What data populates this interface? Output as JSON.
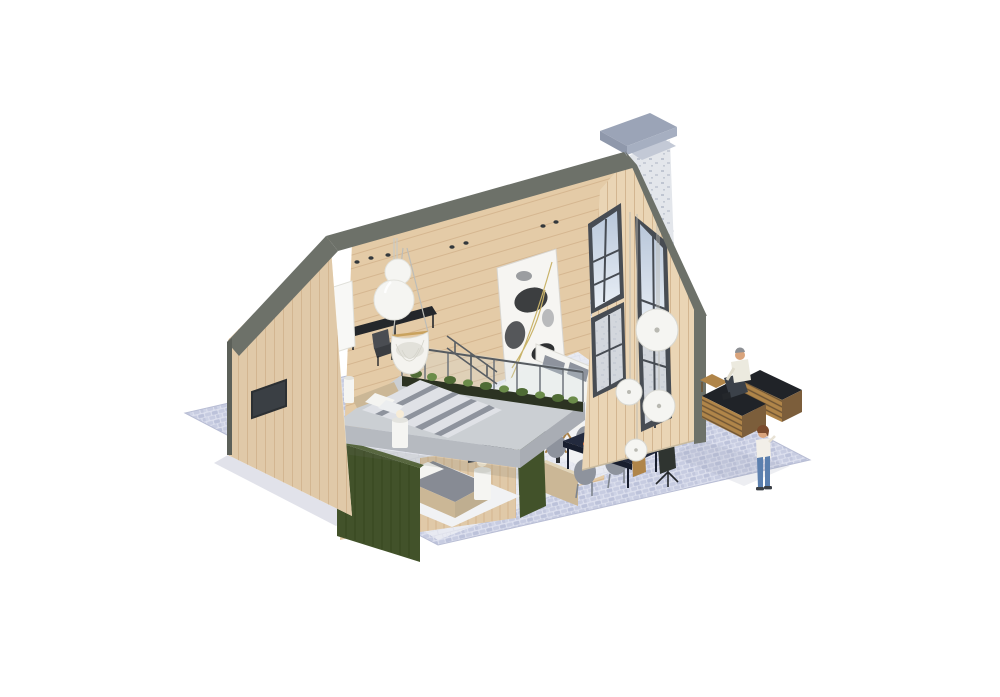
{
  "scene": {
    "type": "isometric-architectural-render",
    "description": "Isometric 3D cutaway render of a barn-style wooden house with loft bedroom, lower bedroom with green wardrobe, living room with white sofa and abstract art, dining area, large gabled window wall with chimney, and an outdoor patio with two people on a cobblestone plaza",
    "objects": [
      "cobblestone-plaza",
      "chimney",
      "roof-trim",
      "rear-gable-wall",
      "wall-window",
      "interior-plank-wall",
      "ceiling-spotlights",
      "sphere-pendant-lamp",
      "hanging-egg-chair",
      "loft-desk",
      "presentation-panel",
      "loft-railing-planter",
      "loft-bed",
      "mezzanine-slab",
      "green-wardrobe",
      "lower-bedroom-bed",
      "nightstand-lamps",
      "green-partition",
      "sideboard",
      "dining-table",
      "dining-chairs",
      "disc-pendant-lamps",
      "floor-lamp",
      "potted-plants",
      "stone-chimney-breast",
      "television",
      "fireplace",
      "abstract-artwork",
      "white-sofa",
      "butterfly-chair",
      "front-gable-window-wall",
      "outdoor-sofa",
      "sitting-man",
      "standing-child"
    ]
  },
  "colors": {
    "background": "#ffffff",
    "roof_trim": "#6d7169",
    "wood_exterior": "#ead5b5",
    "wood_exterior_shade": "#e0c9a8",
    "plank_line": "#d3b691",
    "wood_interior": "#e4cba7",
    "plank_line_interior": "#d2b38c",
    "wood_cut": "#f2e6ce",
    "stone_light": "#e3e6eb",
    "stone_speckle": "#b6bdca",
    "chimney_cap": "#9ba4b7",
    "window_frame": "#474c53",
    "glass_sky": "#c7d3e2",
    "glass_interior": "#d3d7dd",
    "concrete_top": "#cbcfd3",
    "concrete_front": "#b6bac0",
    "concrete_side": "#a9adb4",
    "cabinet_green": "#42522a",
    "ground_cobble": "#c7cce1",
    "ground_joint": "#dde0ee",
    "floor_interior": "#e8eaf2",
    "rug_white": "#f1f2f4",
    "sofa_white": "#f4f4f1",
    "textile_gray": "#8e939d",
    "duvet_light": "#dfe1e6",
    "headboard_beige": "#cbb796",
    "table_navy": "#232a3e",
    "accent_orange": "#e05a1f",
    "wood_furniture": "#b08549",
    "cushion_dark": "#202328",
    "plant_green": "#4f6b35",
    "plant_green_light": "#6b8c4a",
    "planter_dark": "#2c3322",
    "metal_dark": "#24272b",
    "lamp_white": "#f5f5f2",
    "skin": "#d9a47c",
    "denim": "#5b7fae",
    "shadow": "#9aa0b8"
  }
}
